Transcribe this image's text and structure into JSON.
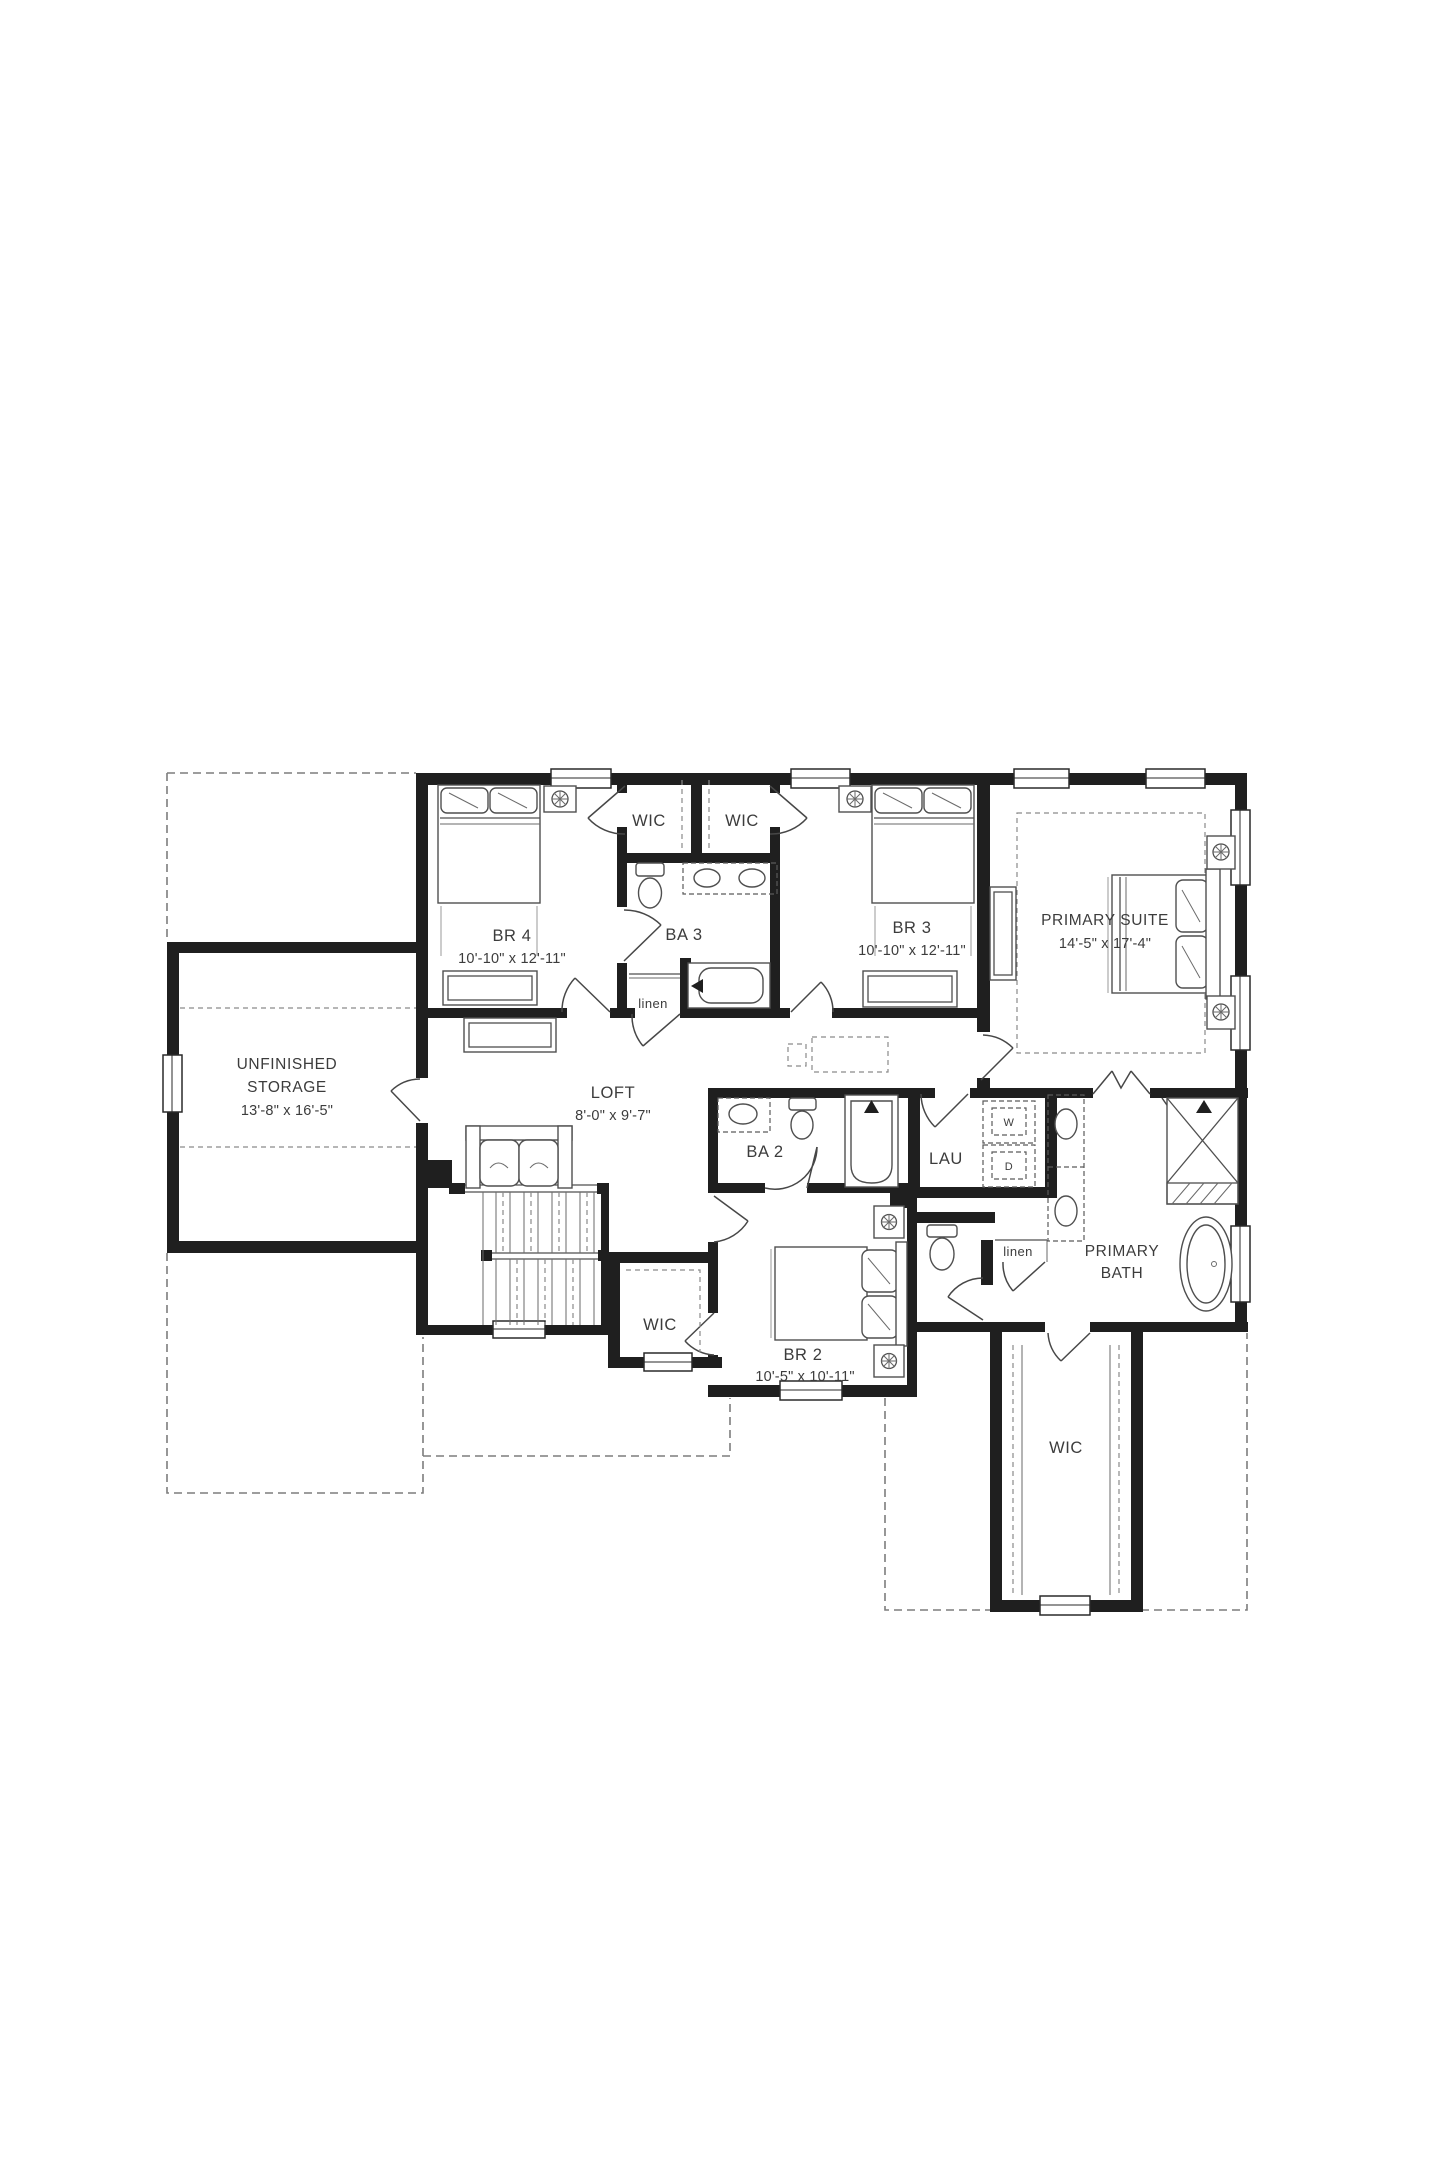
{
  "plan": {
    "colors": {
      "wall": "#1f1f1f",
      "line": "#4f4f4f",
      "dashed_roofline": "#7d7d7d",
      "text": "#3c3c3c",
      "background": "#ffffff"
    },
    "rooms": {
      "br4": {
        "name": "BR 4",
        "dims": "10'-10\" x 12'-11\""
      },
      "wic_br4": {
        "name": "WIC"
      },
      "wic_br3": {
        "name": "WIC"
      },
      "ba3": {
        "name": "BA 3"
      },
      "linen_upper": {
        "name": "linen"
      },
      "br3": {
        "name": "BR 3",
        "dims": "10'-10\" x 12'-11\""
      },
      "primary_suite": {
        "name": "PRIMARY SUITE",
        "dims": "14'-5\" x 17'-4\""
      },
      "storage": {
        "name_line1": "UNFINISHED",
        "name_line2": "STORAGE",
        "dims": "13'-8\" x 16'-5\""
      },
      "loft": {
        "name": "LOFT",
        "dims": "8'-0\" x 9'-7\""
      },
      "ba2": {
        "name": "BA 2"
      },
      "lau": {
        "name": "LAU",
        "washer": "W",
        "dryer": "D"
      },
      "linen_lower": {
        "name": "linen"
      },
      "primary_bath": {
        "name_line1": "PRIMARY",
        "name_line2": "BATH"
      },
      "br2": {
        "name": "BR 2",
        "dims": "10'-5\" x 10'-11\""
      },
      "wic_br2": {
        "name": "WIC"
      },
      "wic_primary": {
        "name": "WIC"
      }
    }
  }
}
